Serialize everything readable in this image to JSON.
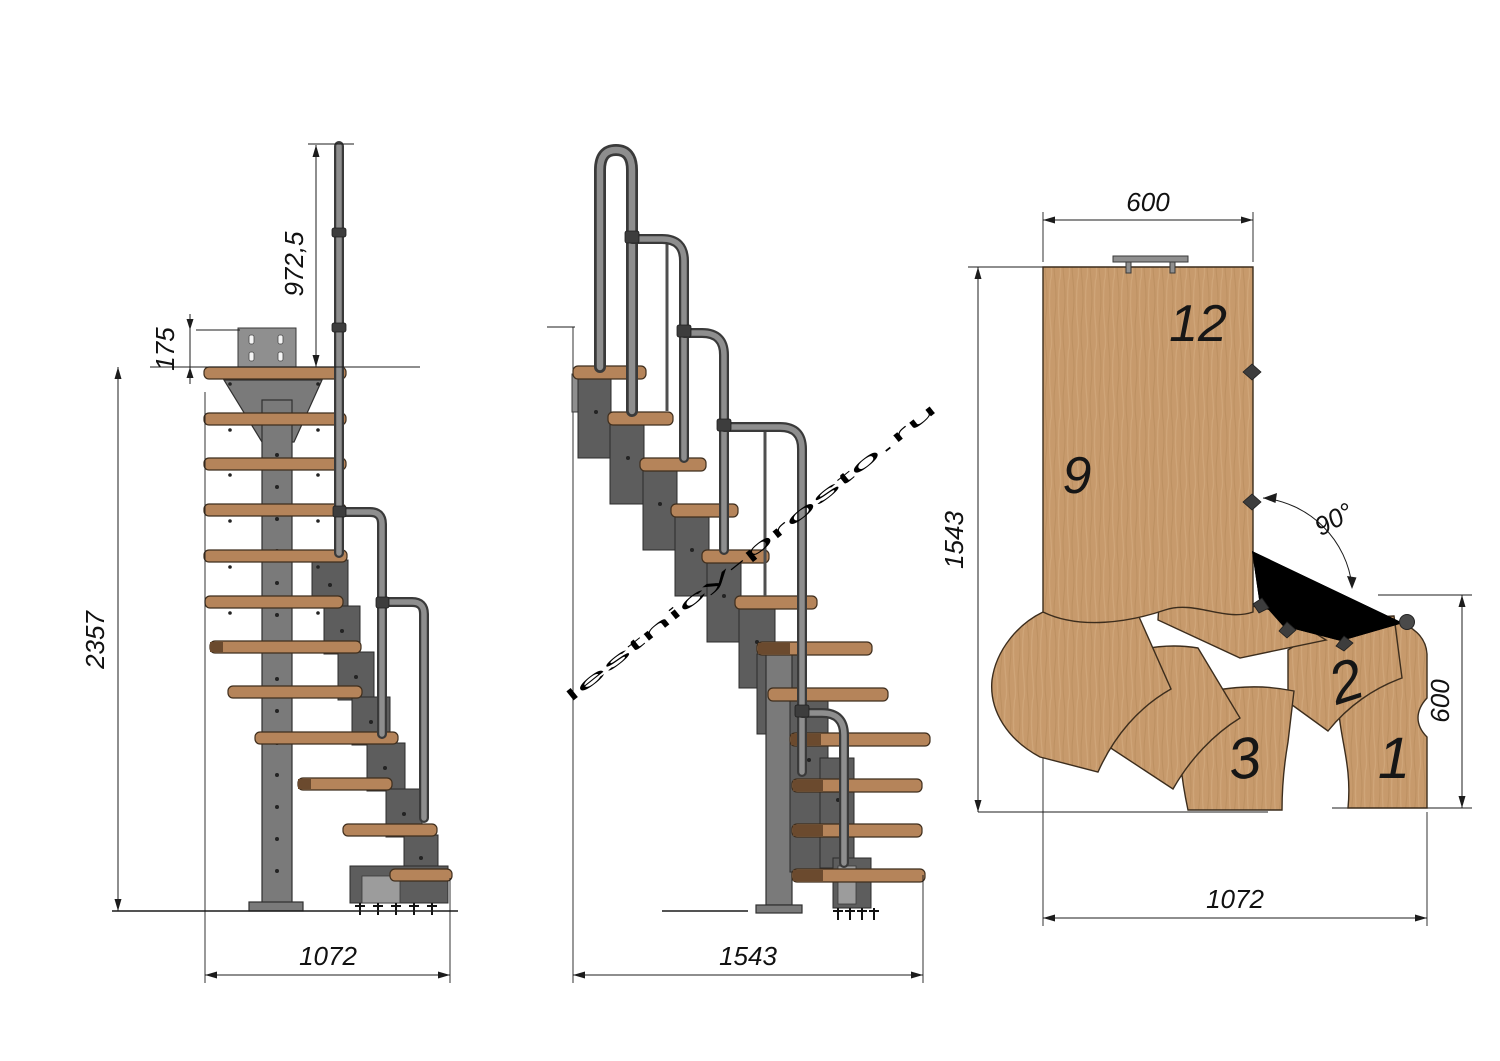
{
  "drawing": {
    "kind": "modular staircase technical drawing, three views",
    "background": "#ffffff"
  },
  "watermark": {
    "text": "lestnicy-prosto.ru",
    "color": "#a8a8a8"
  },
  "palette": {
    "wood_side": "#b5845a",
    "wood_plan": "#c79a6c",
    "wood_edge": "#3c2d1d",
    "metal_light": "#8e8e8e",
    "metal_mid": "#5d5d5d",
    "metal_dark": "#3a3a3a",
    "dimension_lines": "#1c1c1c"
  },
  "views": {
    "side": {
      "title": "side elevation",
      "dims": {
        "rail_height": "972,5",
        "plate_offset": "175",
        "total_height": "2357",
        "footprint_depth": "1072"
      }
    },
    "front": {
      "title": "front elevation",
      "dims": {
        "footprint_width": "1543"
      }
    },
    "plan": {
      "title": "top plan",
      "dims": {
        "top_width": "600",
        "left_depth": "1543",
        "right_depth": "600",
        "bottom_width": "1072",
        "turn_angle": "90°"
      },
      "tread_labels": {
        "t12": "12",
        "t9": "9",
        "t3": "3",
        "t2": "2",
        "t1": "1"
      }
    }
  }
}
